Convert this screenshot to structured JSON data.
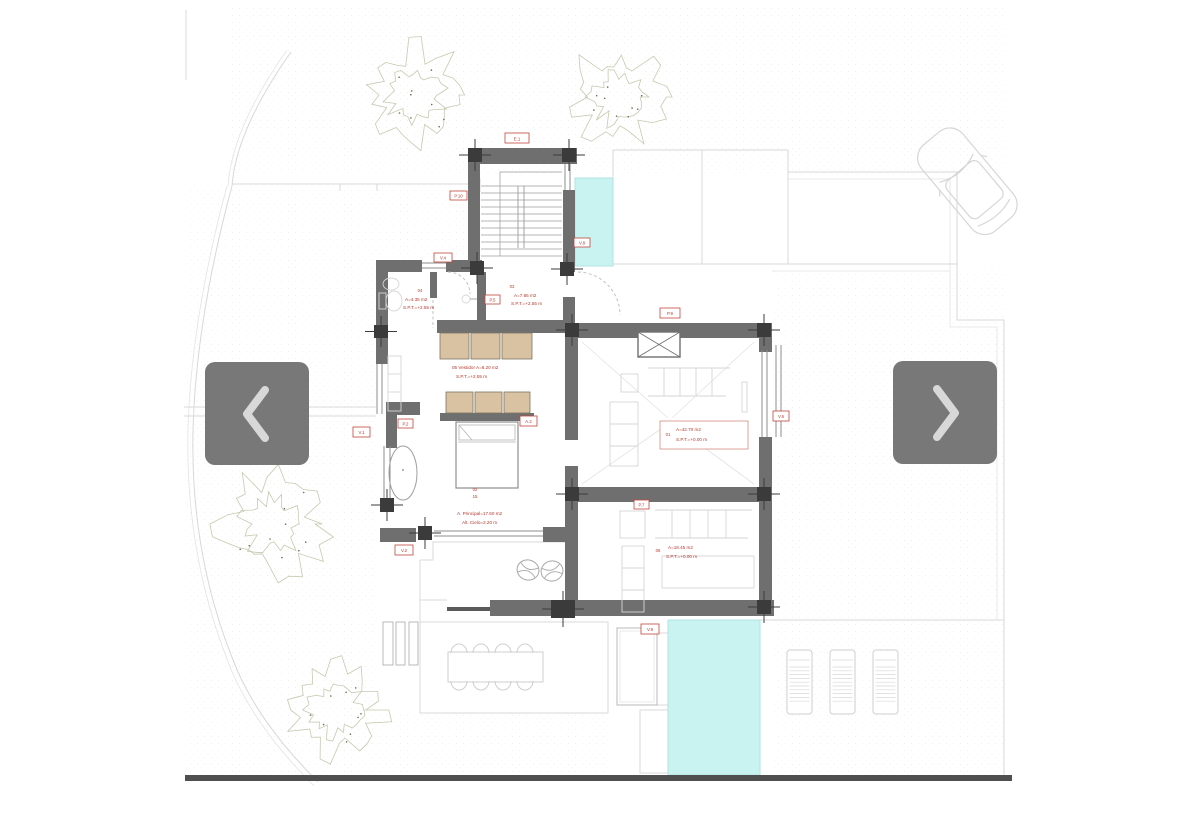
{
  "view": {
    "background": "#ffffff",
    "content": "architectural ground-floor plan with garden, pools and terraces"
  },
  "carousel": {
    "prev_button": {
      "icon": "chevron-left"
    },
    "next_button": {
      "icon": "chevron-right"
    },
    "button_color": "#787878",
    "chevron_color": "#d8d8d8"
  },
  "floor_plan": {
    "colors": {
      "wall": "#6f6f6f",
      "column": "#3b3b3b",
      "pool": "#c9f3f1",
      "annotation_red": "#b4392c",
      "wardrobe_tan": "#d8c2a2",
      "ground_line": "#d8d8d8"
    },
    "tags": {
      "stair_top": "E.1",
      "stair_left": "P.10",
      "bath_window": "V.4",
      "hall_door": "P.5",
      "pool_side": "V.8",
      "hall_arc": "P.9",
      "wardrobe": "A.2",
      "bedroom_window": "V.1",
      "corner_door": "P.2",
      "terrace_door": "V.2",
      "living_window": "V.6",
      "room2_door": "P.7",
      "pool2": "V.9"
    },
    "rooms": {
      "bath": {
        "tag": "04",
        "area": "A=4.35 m2",
        "level": "S.P.T.=+2.55 m"
      },
      "hall": {
        "tag": "03",
        "area": "A=7.85 m2",
        "level": "S.P.T.=+2.55 m"
      },
      "vestidor": {
        "area": "05 Vestidor A=6.20 m2",
        "level": "S.P.T.=+2.55 m"
      },
      "bedroom": {
        "tag": "02",
        "tag2": "15",
        "area": "A. Principal=17.50 m2",
        "level": "Alt. Cielo=2.20 m"
      },
      "living": {
        "tag": "01",
        "area": "A=42.70 m2",
        "level": "S.P.T.=+0.00 m"
      },
      "room2": {
        "tag": "06",
        "area": "A=18.45 m2",
        "level": "S.P.T.=+0.00 m"
      }
    }
  }
}
